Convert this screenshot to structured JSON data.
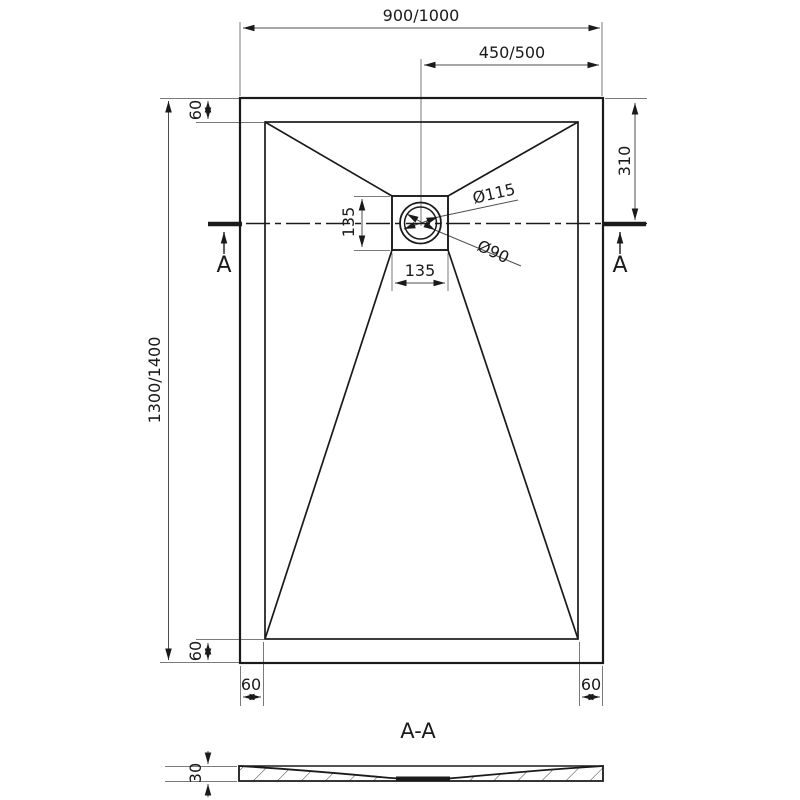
{
  "top_view": {
    "dim_width_overall": "900/1000",
    "dim_width_to_drain": "450/500",
    "dim_length_overall": "1300/1400",
    "dim_drain_from_top": "310",
    "dim_rim_top": "60",
    "dim_rim_bottom": "60",
    "dim_rim_bottom_left": "60",
    "dim_rim_bottom_right": "60",
    "dim_drain_square_width": "135",
    "dim_drain_square_height": "135",
    "label_drain_outer_diameter": "Ø115",
    "label_drain_inner_diameter": "Ø90",
    "section_marker_left": "A",
    "section_marker_right": "A"
  },
  "section_view": {
    "label": "A-A",
    "dim_thickness": "30"
  },
  "colors": {
    "object_line": "#1a1a1a",
    "dimension_line": "#5a5a5a",
    "extension_line": "#7a7a7a",
    "background": "#ffffff"
  }
}
